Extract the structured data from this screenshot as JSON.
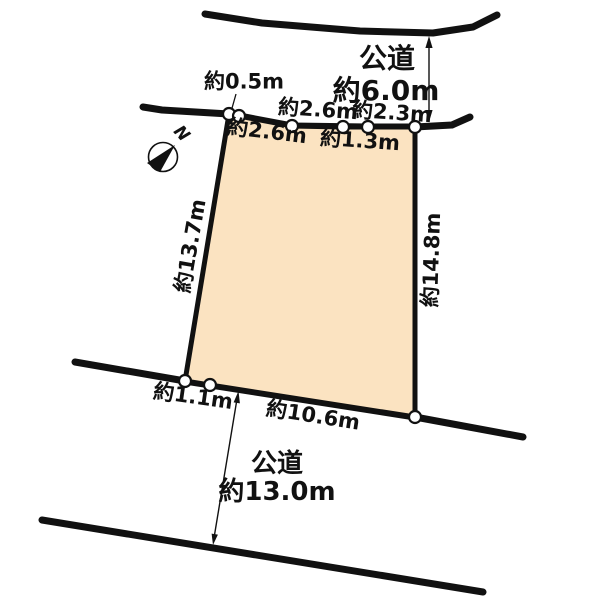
{
  "diagram": {
    "type": "land-plot-survey",
    "background_color": "#ffffff",
    "line_color": "#111111",
    "plot_fill_color": "#FBE3C1",
    "compass": {
      "label": "N"
    },
    "roads": {
      "top": {
        "name": "公道",
        "width": "約6.0m"
      },
      "bottom": {
        "name": "公道",
        "width": "約13.0m"
      }
    },
    "plot": {
      "top_edge_segments": [
        {
          "label": "約0.5m"
        },
        {
          "label": "約2.6m"
        },
        {
          "label": "約2.6m"
        },
        {
          "label": "約1.3m"
        },
        {
          "label": "約2.3m"
        }
      ],
      "left_edge": {
        "label": "約13.7m"
      },
      "right_edge": {
        "label": "約14.8m"
      },
      "bottom_edge_segments": [
        {
          "label": "約1.1m"
        },
        {
          "label": "約10.6m"
        }
      ]
    }
  }
}
